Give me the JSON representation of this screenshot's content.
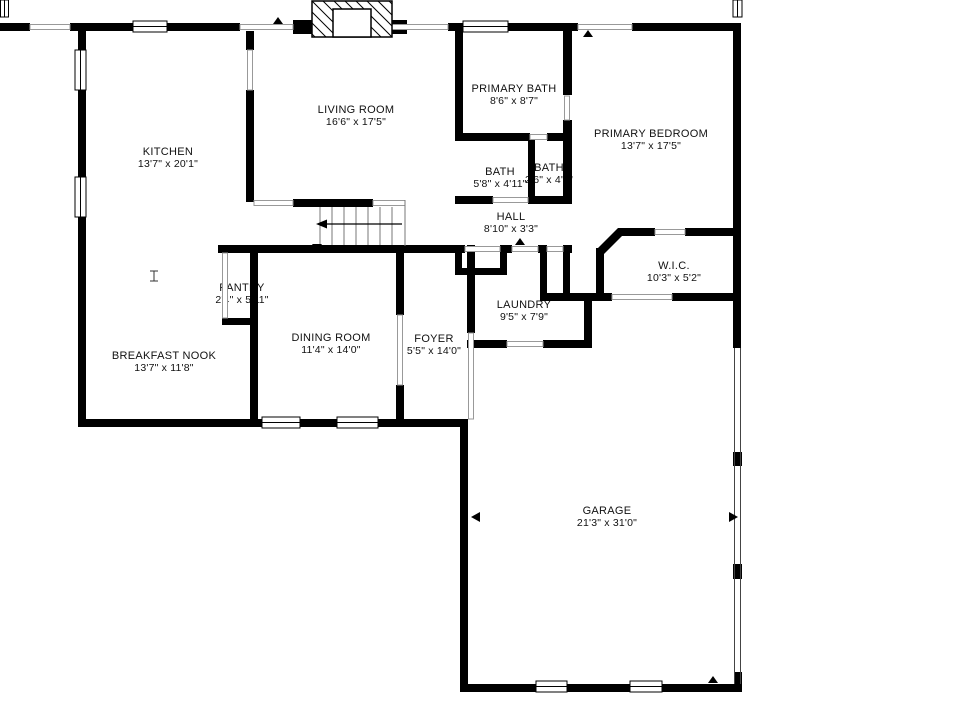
{
  "meta": {
    "type": "residential-floor-plan",
    "background_color": "#ffffff",
    "wall_color": "#000000",
    "thin_line_color": "#999999",
    "text_color": "#111111"
  },
  "rooms": [
    {
      "name": "KITCHEN",
      "dims": "13'7\" x 20'1\""
    },
    {
      "name": "LIVING ROOM",
      "dims": "16'6\" x 17'5\""
    },
    {
      "name": "PRIMARY BATH",
      "dims": "8'6\" x 8'7\""
    },
    {
      "name": "PRIMARY BEDROOM",
      "dims": "13'7\" x 17'5\""
    },
    {
      "name": "BATH",
      "dims": "5'8\" x 4'11\""
    },
    {
      "name": "BATH",
      "dims": "2'6\" x 4'1\""
    },
    {
      "name": "HALL",
      "dims": "8'10\" x 3'3\""
    },
    {
      "name": "W.I.C.",
      "dims": "10'3\" x 5'2\""
    },
    {
      "name": "PANTRY",
      "dims": "2'4\" x 5'11\""
    },
    {
      "name": "LAUNDRY",
      "dims": "9'5\" x 7'9\""
    },
    {
      "name": "DINING ROOM",
      "dims": "11'4\" x 14'0\""
    },
    {
      "name": "FOYER",
      "dims": "5'5\" x 14'0\""
    },
    {
      "name": "BREAKFAST NOOK",
      "dims": "13'7\" x 11'8\""
    },
    {
      "name": "GARAGE",
      "dims": "21'3\" x 31'0\""
    }
  ]
}
